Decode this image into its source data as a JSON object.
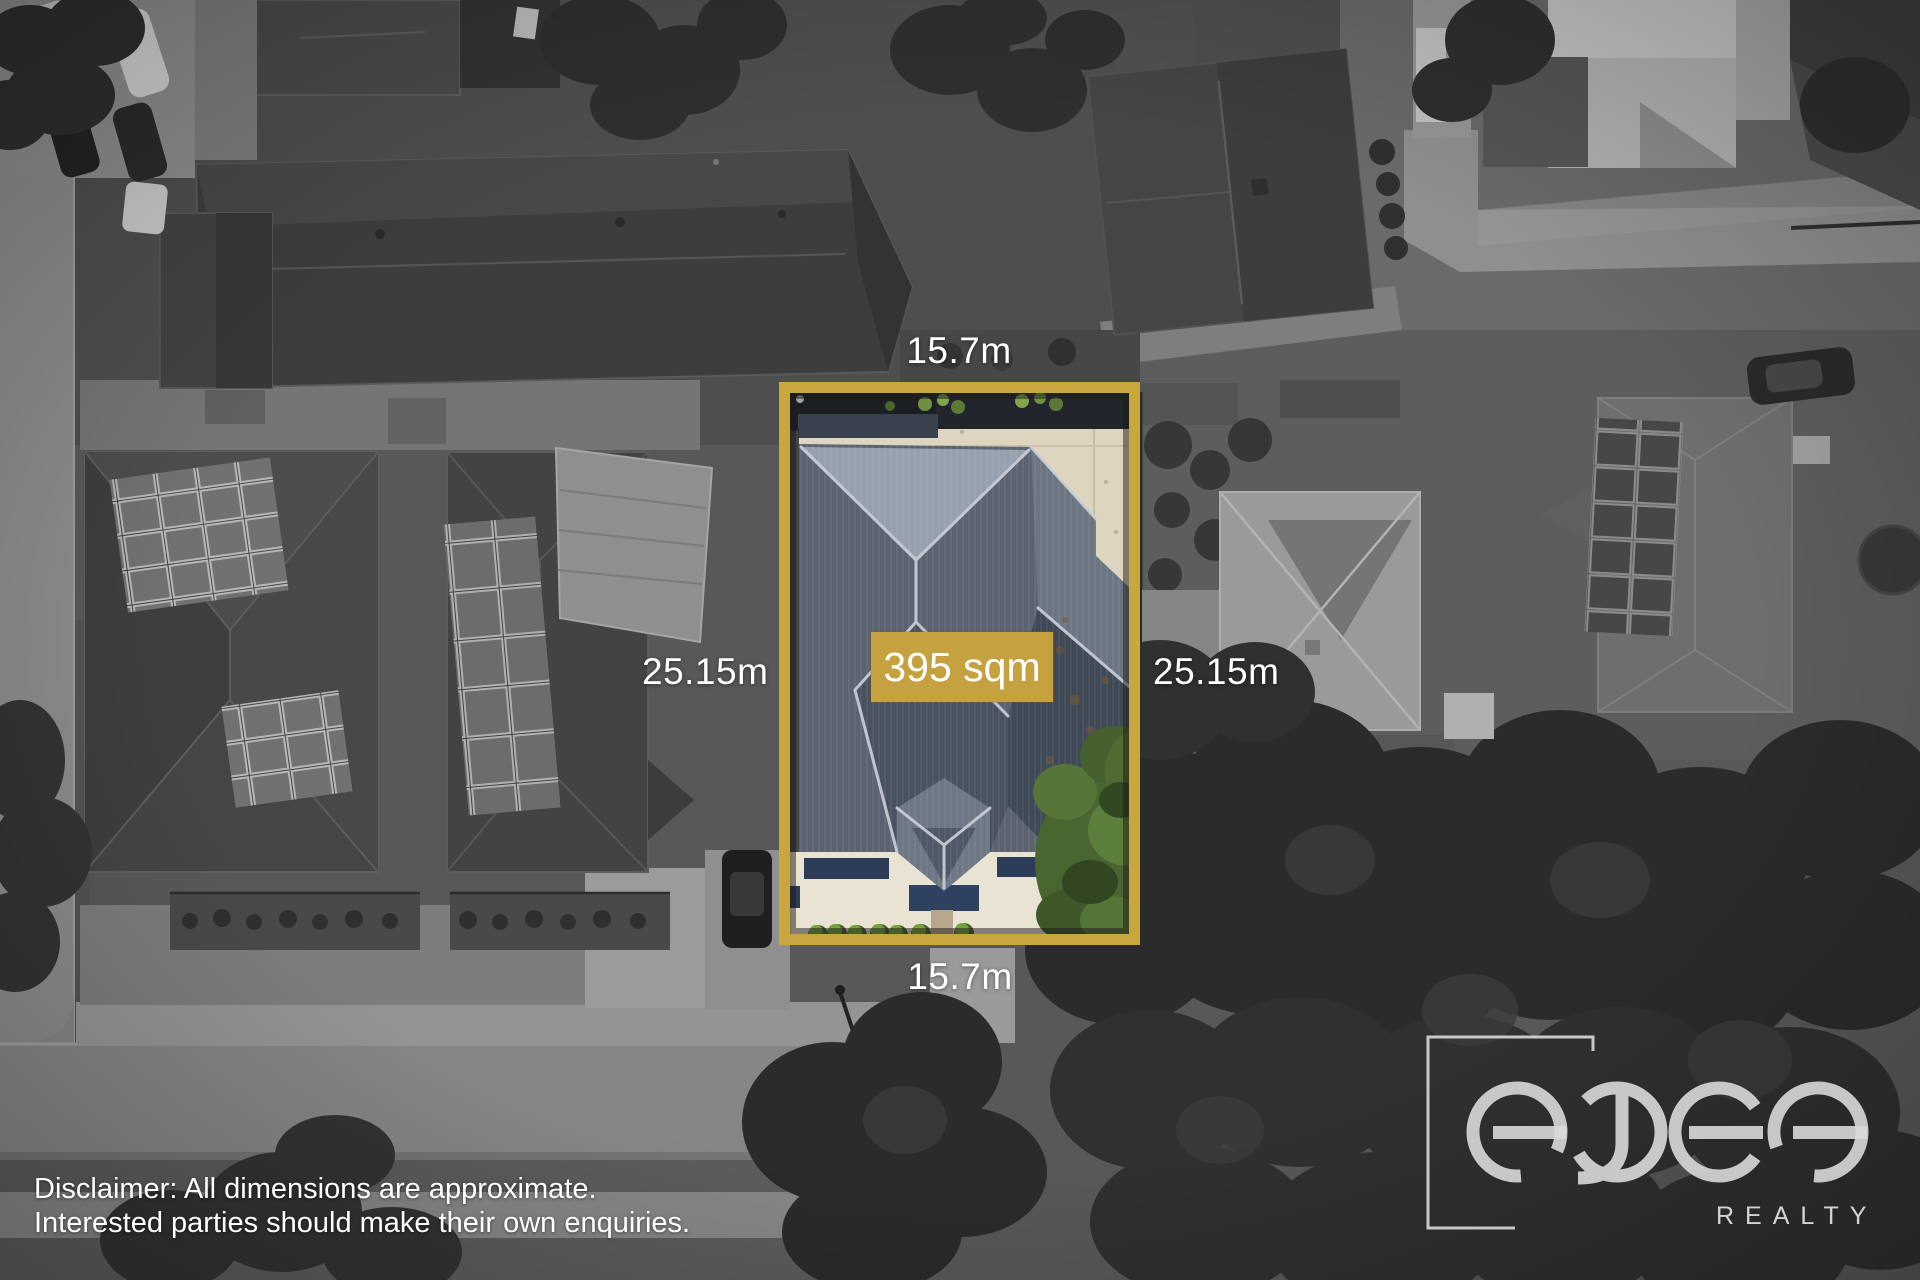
{
  "image_type": "real-estate-aerial-lot-highlight",
  "colors": {
    "accent_gold": "#C5A23F",
    "border_gold": "#C9A63E",
    "label_text": "#FFFFFF"
  },
  "lot": {
    "area": "395 sqm",
    "dimensions": {
      "top": "15.7m",
      "bottom": "15.7m",
      "left": "25.15m",
      "right": "25.15m"
    }
  },
  "disclaimer": {
    "line1": "Disclaimer: All dimensions are approximate.",
    "line2": "Interested parties should make their own enquiries."
  },
  "brand": {
    "wordmark": "edge",
    "tagline": "REALTY"
  }
}
